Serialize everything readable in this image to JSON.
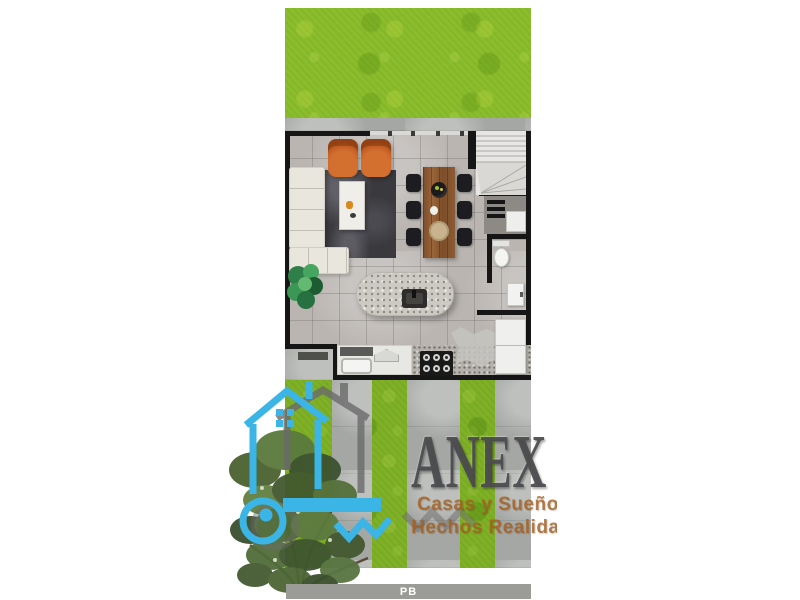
{
  "canvas": {
    "width": 800,
    "height": 600,
    "background": "#ffffff"
  },
  "watermark": {
    "brand": "ANEX",
    "tagline_line1": "Casas y Sueños",
    "tagline_line2": "Hechos Realidad",
    "logo_blue": "#3ab5e6",
    "logo_shadow_gray": "#6b6b6b",
    "brand_text_color": "#48484b",
    "tagline_color": "#a56022"
  },
  "floor_label": {
    "text": "PB",
    "bar_color": "#9b9b98",
    "text_color": "#ffffff"
  },
  "palette": {
    "grass_front": "#8abc2c",
    "grass_back": "#7fb026",
    "concrete": "#a4a7a3",
    "wall": "#161616",
    "floor_tile": "#bab5b1",
    "sofa": "#e9e6dd",
    "rug": "#3a393d",
    "accent_chair": "#c2591f",
    "dining_wood": "#8a5835",
    "island_stone": "#cdcac3"
  }
}
